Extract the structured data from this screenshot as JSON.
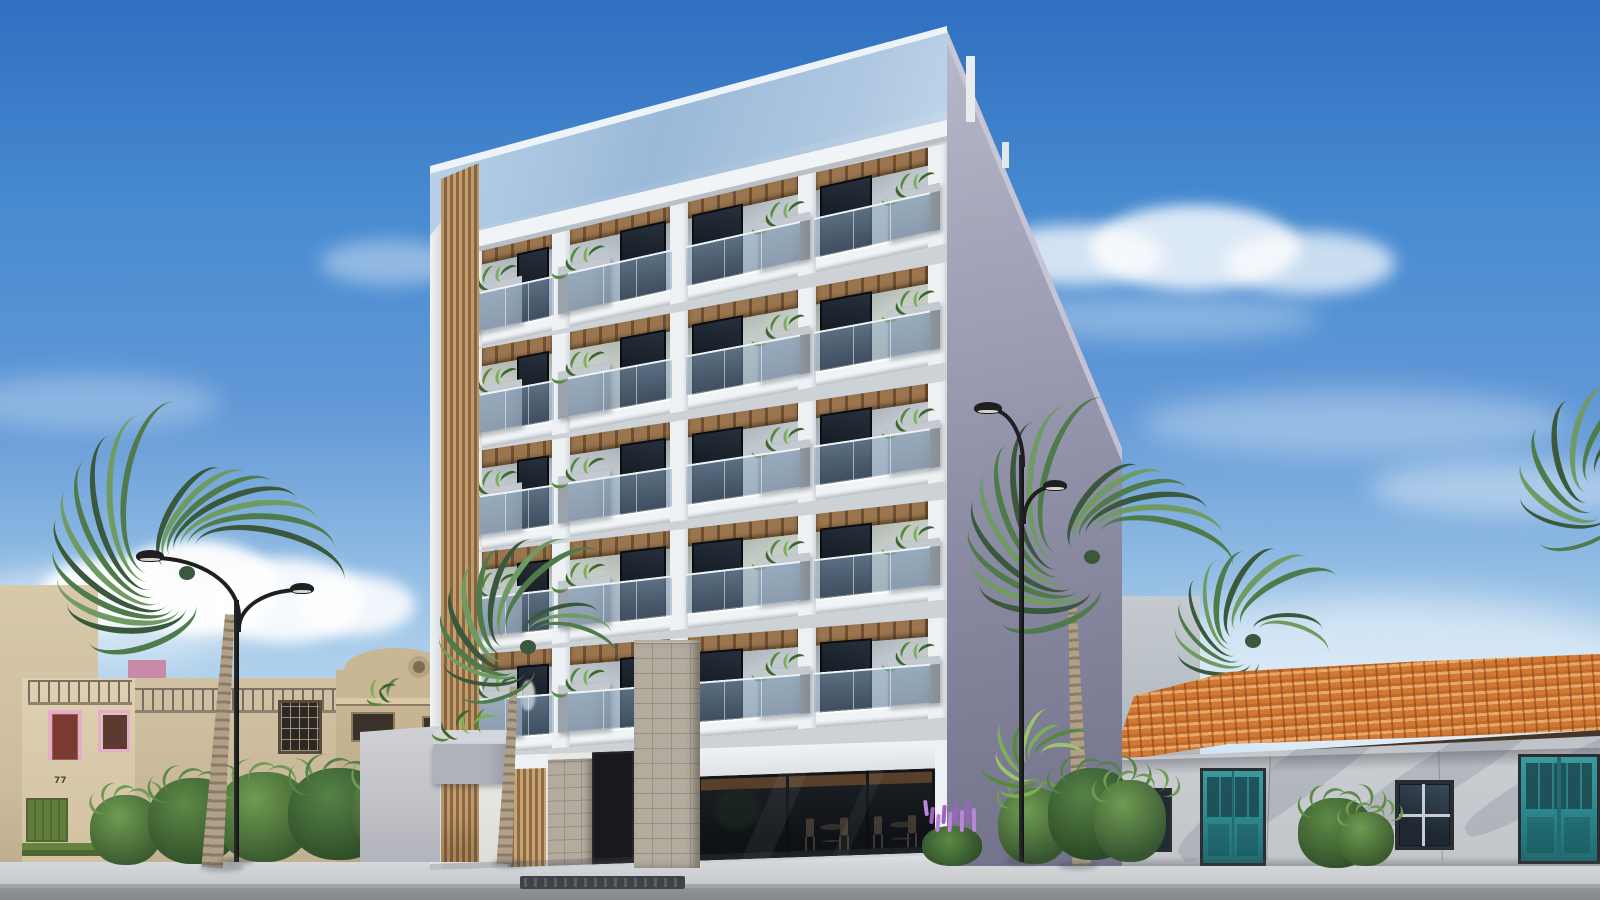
{
  "scene": {
    "type": "architectural-render",
    "setting": "modern condo building on a sunny street with palms",
    "width": 1600,
    "height": 900
  },
  "palette": {
    "sky_top": "#2f6fc0",
    "sky_mid": "#6198d6",
    "sky_low": "#a9cdea",
    "sky_horizon": "#e2eef7",
    "cloud": "#ffffff",
    "facade_white": "#eef1f4",
    "facade_shadow": "#cdd2d7",
    "slab": "#f1f4f6",
    "glass_band": "#a9c2dc",
    "glass_rail": "#8fadc9",
    "wood_light": "#c9a473",
    "wood_dark": "#8f6b45",
    "ceiling_dark": "#6e4f33",
    "ceiling_light": "#9a754e",
    "cell_back": "#c7cfd5",
    "window_dark": "#10161e",
    "window_mid": "#27313d",
    "planter": "#9aa2aa",
    "planter_light": "#c4c9cf",
    "plant_green": "#57893c",
    "plant_dark": "#3c662c",
    "plant_light": "#7cb054",
    "side_top": "#bcbcce",
    "side_bottom": "#6f7088",
    "stone": "#b2ab9e",
    "store_dark": "#14181d",
    "store_wood": "#5f422a",
    "fence": "#c6c7cc",
    "box_gray": "#aeb2ba",
    "cream": "#d9c9ab",
    "cream_light": "#dfd0b2",
    "beige": "#d2c2a4",
    "mission": "#c9b694",
    "mission_trim": "#d9c9a9",
    "gray_blue": "#8b93a3",
    "pink": "#c98aa8",
    "pink_trim": "#e3aec6",
    "door_maroon": "#7a3a31",
    "green_stripe": "#66823f",
    "green_dark": "#4d6631",
    "tile": "#cf7935",
    "tile_light": "#e09050",
    "fascia": "#453629",
    "right_wall": "#c8ccd0",
    "teal": "#2e8b91",
    "teal_dark": "#206a70",
    "frame_dark": "#2b2d30",
    "trunk": "#b1a089",
    "trunk_dark": "#8c7c66",
    "frond": "#4f7a4a",
    "frond_dark": "#3a583c",
    "frond_light": "#6f9b62",
    "lamp_black": "#1d1f21",
    "lamp_glow": "#d9d5c9",
    "flower_purple": "#9a63bd",
    "flower_light": "#bb86d8",
    "road": "#8f9498",
    "sidewalk": "#d5d8db",
    "curb": "#9fa5a9",
    "grate": "#3f4347"
  },
  "sky": {
    "clouds": 6
  },
  "main_building": {
    "floors": 5,
    "bays_per_floor": 4,
    "planter_sides": [
      "left",
      "left",
      "right",
      "right"
    ],
    "balcony": {
      "ceiling": "wood planks",
      "railing": "frameless glass",
      "planter": "concrete box with plants"
    },
    "wood_slat_accent": true,
    "glass_roof_parapet": true,
    "ground_floor": {
      "storefront_panes": 3,
      "stone_pillars": 2,
      "chairs": 4,
      "tables": 2
    }
  },
  "left_buildings": {
    "house_number": "77",
    "style": "mission parapet houses",
    "rooftop_railing": true
  },
  "right_building": {
    "roof": "terracotta tiles",
    "teal_doors": 2,
    "windows": 2
  },
  "street": {
    "lamps": 2,
    "palms": 5,
    "flower_color": "purple"
  }
}
